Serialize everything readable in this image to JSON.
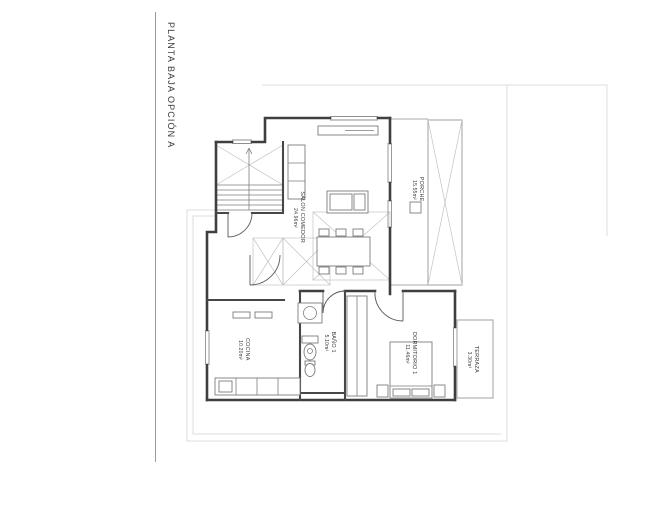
{
  "title": "PLANTA BAJA OPCIÓN A",
  "plan": {
    "rooms": [
      {
        "name": "SALON COMEDOR",
        "area": "24.96m²"
      },
      {
        "name": "PORCHE",
        "area": "15.55m²"
      },
      {
        "name": "COCINA",
        "area": "10.20m²"
      },
      {
        "name": "BAÑO 1",
        "area": "5.10m²"
      },
      {
        "name": "DORMITORIO 1",
        "area": "11.46m²"
      },
      {
        "name": "TERRAZA",
        "area": "3.30m²"
      }
    ],
    "colors": {
      "walls": "#3f3f3f",
      "faint_outline": "#d4d4d4",
      "text": "#3a3a3a",
      "background": "#ffffff"
    }
  }
}
